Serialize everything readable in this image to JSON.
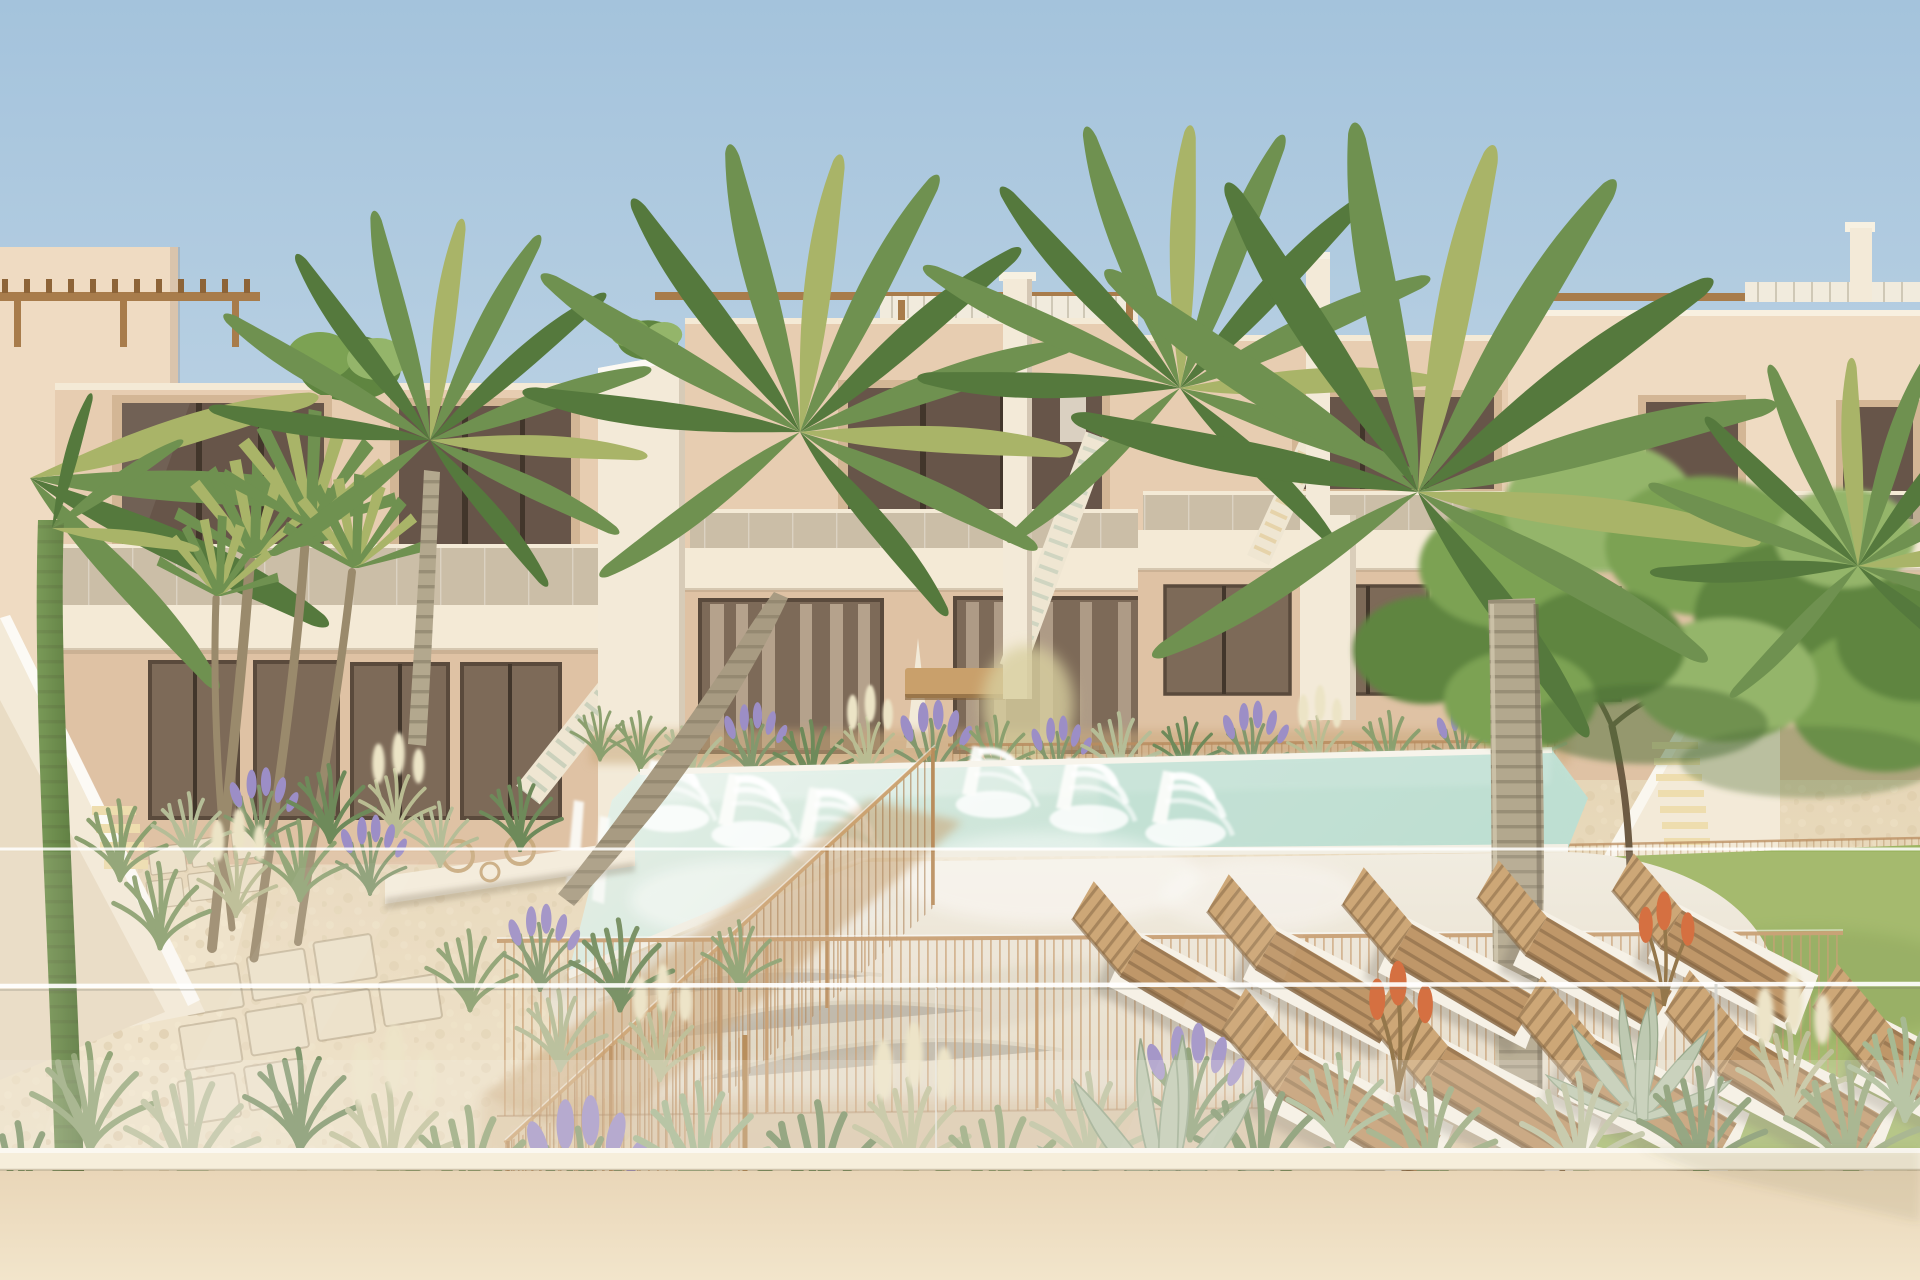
{
  "scene": {
    "type": "natural-image",
    "alt": "Sunny 3D rendering of a modern beige two-storey apartment complex with roof pergolas and external staircases around a communal swimming pool with in-water loungers and fountain jets, wooden sun loungers on a white deck, desert-style gardens with grasses, lavender and agaves, palm trees and a leafy tree over a green lawn, viewed from a balcony over a glass balustrade and cream parapet wall",
    "time_of_day": "day",
    "weather": "clear blue sky"
  },
  "inventory": {
    "apartment_blocks": 4,
    "floors_per_block": 2,
    "roof_pergolas": 4,
    "external_staircases": 4,
    "swimming_pools": 1,
    "in_pool_loungers": 6,
    "fountain_jets": 6,
    "wooden_sun_loungers": 10,
    "palm_trees": 7,
    "leafy_trees": 1,
    "agave_plants": 2,
    "lawns": 1,
    "pool_fence": "thin timber-post wire fence",
    "foreground": "glass balustrade over cream parapet wall"
  },
  "palette": {
    "sky-top": "#a4c3dc",
    "sky-mid": "#c6d9e7",
    "sky-low": "#e4edf2",
    "wall": "#e7cdb1",
    "wall-2": "#dfc2a4",
    "wall-dark": "#cfae8d",
    "wall-light": "#efdbc2",
    "trim": "#f4ead6",
    "blade": "#f3ead8",
    "step": "#c9d0ba",
    "step-lit": "#eeddae",
    "win-rim": "#d3b695",
    "win-dark": "#675549",
    "win-frame": "#42362b",
    "win-glass": "#7d6a58",
    "curtain": "#c3b19a",
    "pergola": "#a87c4b",
    "pergola-dark": "#8d6438",
    "pergola-white": "#f1ebdd",
    "water-1": "#e8f2ea",
    "water-2": "#cfe6da",
    "water-3": "#bedfd2",
    "coping": "#f7f4eb",
    "deck": "#f1ece0",
    "deck-2": "#e3d9c5",
    "gravel": "#e6d6b7",
    "gravel-2": "#efe3c9",
    "pebble-dark": "#c9b390",
    "mulch": "#c9a87c",
    "paver": "#ece1c9",
    "lawn": "#9cb561",
    "lawn-2": "#aac272",
    "lawn-dark": "#7d9a4b",
    "tree-1": "#7ca253",
    "tree-2": "#5f8540",
    "tree-3": "#94b56a",
    "tree-dark": "#4c6d35",
    "branch": "#6d5b43",
    "palm-green": "#6f9150",
    "palm-dark": "#55793d",
    "palm-yellow": "#a9b468",
    "trunk": "#b3a88e",
    "trunk-2": "#8f8570",
    "stalk": "#6a8a4a",
    "grass-g": "#8ba06f",
    "grass-p": "#b5bd97",
    "grass-d": "#6e8a5a",
    "lavender": "#9c8ec6",
    "plume": "#ece4c6",
    "wood": "#b98e5c",
    "wood-2": "#c9a06b",
    "wood-dark": "#7c5a34",
    "pad": "#f6f2e7",
    "fence": "#c59a6b",
    "agave": "#b8c6ac",
    "bloom": "#d2622f",
    "front-wall": "#e9d6b8",
    "front-wall-2": "#f2e5cb",
    "wall-lip": "#f6eedb"
  }
}
